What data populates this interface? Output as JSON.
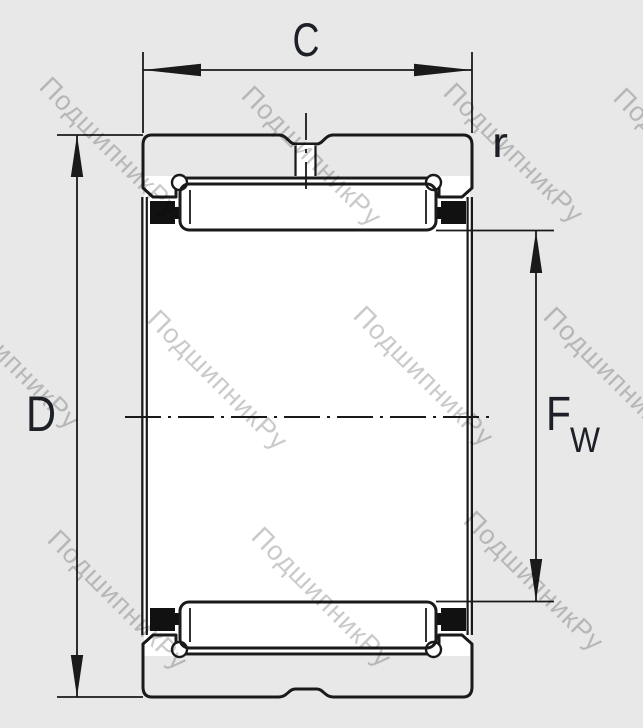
{
  "drawing": {
    "type": "needle-roller-bearing-cross-section",
    "dimensions": {
      "width_label": "C",
      "outer_diameter_label": "D",
      "corner_radius_label": "r",
      "bore_diameter_main": "F",
      "bore_diameter_sub": "W"
    },
    "watermark_text": "ПодшипникРу",
    "colors": {
      "background": "#e8e8e8",
      "ink": "#1a1a1a",
      "label": "#1d2026",
      "watermark": "#c8cacb",
      "ring_fill": "#ffffff",
      "seal_fill": "#111111"
    }
  }
}
